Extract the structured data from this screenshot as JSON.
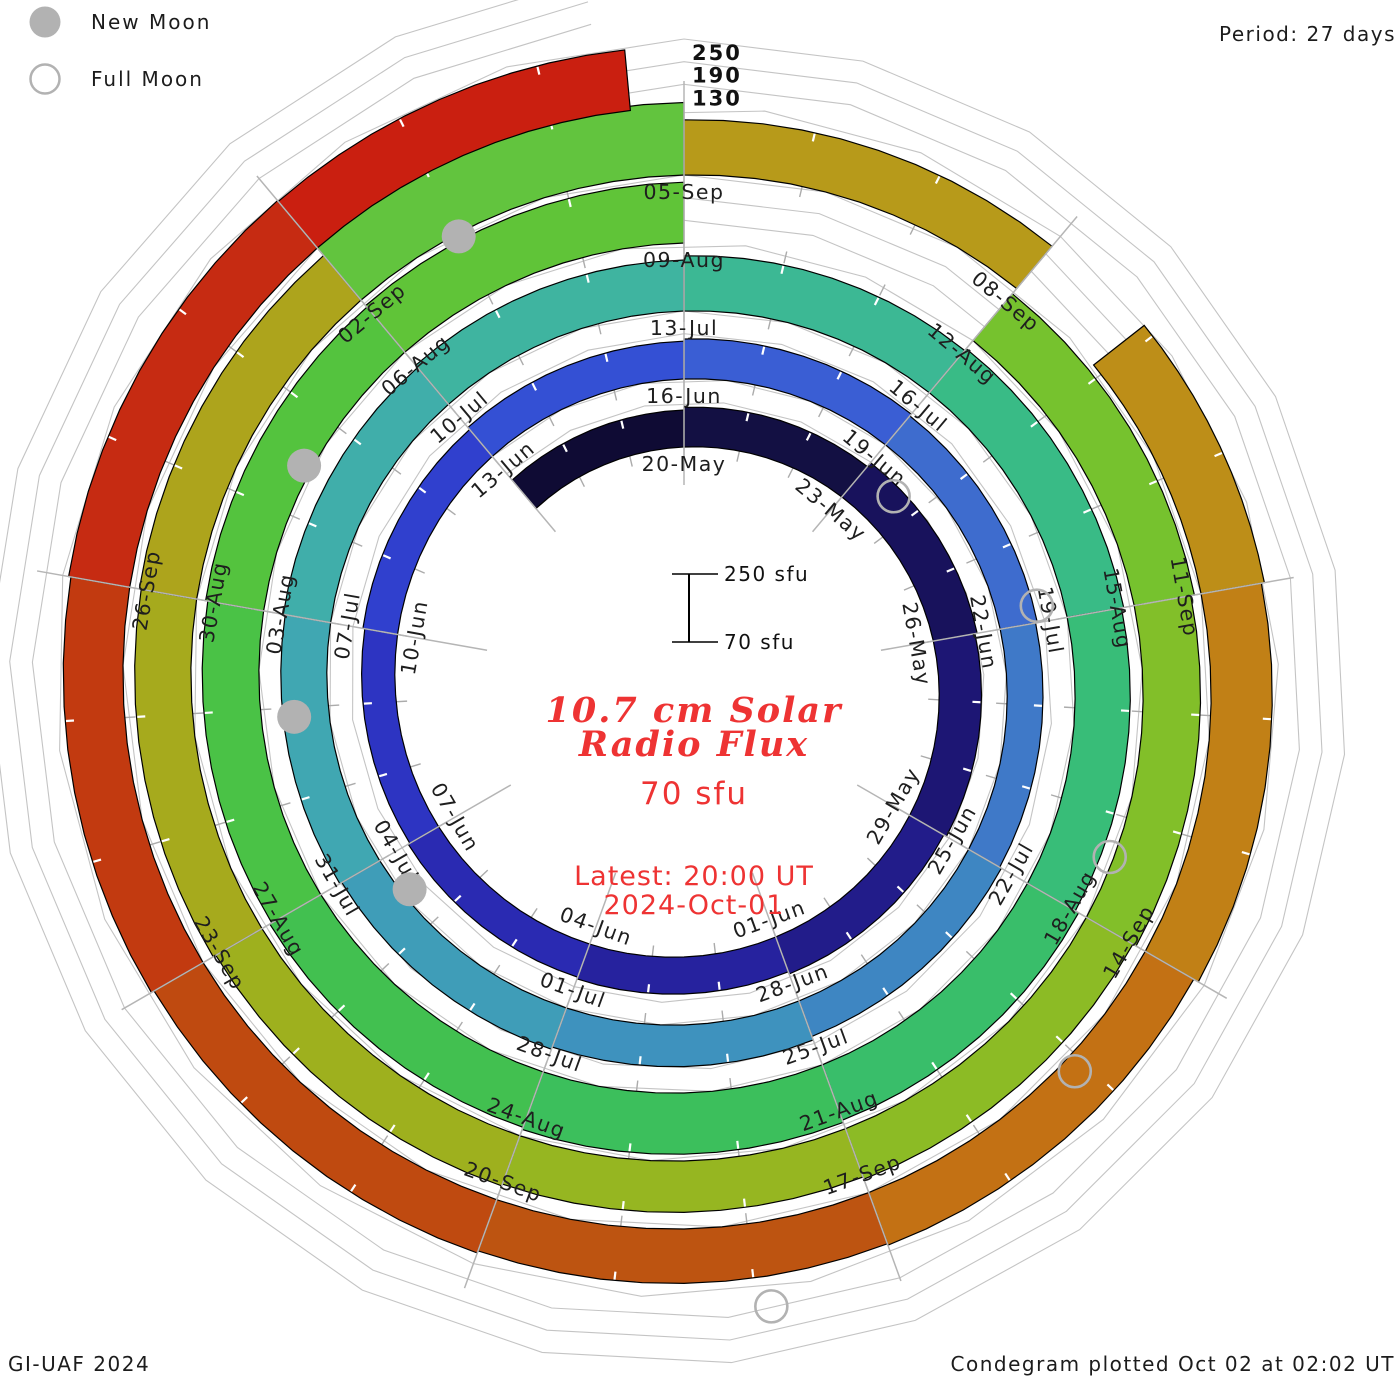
{
  "legend": {
    "items": [
      {
        "label": "New Moon",
        "type": "filled",
        "icon": "new-moon-icon"
      },
      {
        "label": "Full Moon",
        "type": "open",
        "icon": "full-moon-icon"
      }
    ]
  },
  "header": {
    "period_label": "Period: 27 days"
  },
  "footer": {
    "left": "GI-UAF 2024",
    "right": "Condegram plotted Oct 02 at 02:02 UT"
  },
  "center": {
    "title_line1": "10.7 cm Solar",
    "title_line2": "Radio Flux",
    "flux_label": "70 sfu",
    "latest_line1": "Latest: 20:00 UT",
    "latest_line2": "2024-Oct-01",
    "scalebar": {
      "top_label": "250 sfu",
      "bottom_label": "70 sfu"
    }
  },
  "chart_data": {
    "type": "spiral",
    "subtype": "condegram",
    "title": "10.7 cm Solar Radio Flux",
    "period_days": 27,
    "days_per_segment": 3,
    "flux_min": 70,
    "flux_max": 250,
    "radial_ticks": [
      250,
      190,
      130
    ],
    "latest_value_sfu": 70,
    "latest_time": "20:00 UT 2024-Oct-01",
    "grid": true,
    "colors": {
      "grid": "#c4c4c4",
      "spoke": "#b5b5b5",
      "moon": "#b2b2b2",
      "outline": "#000000",
      "label": "#1e1e1e",
      "accent_red": "#ee3333"
    },
    "wedges": [
      {
        "label": "17-May",
        "t0": -3,
        "value": 168,
        "color": "#0f0b34",
        "show_label": false
      },
      {
        "label": "20-May",
        "t0": 0,
        "value": 175,
        "color": "#131043"
      },
      {
        "label": "23-May",
        "t0": 3,
        "value": 188,
        "color": "#18125c"
      },
      {
        "label": "26-May",
        "t0": 6,
        "value": 182,
        "color": "#1d1674"
      },
      {
        "label": "29-May",
        "t0": 9,
        "value": 174,
        "color": "#221c8a"
      },
      {
        "label": "01-Jun",
        "t0": 12,
        "value": 168,
        "color": "#26229e"
      },
      {
        "label": "04-Jun",
        "t0": 15,
        "value": 163,
        "color": "#2a2ab2"
      },
      {
        "label": "07-Jun",
        "t0": 18,
        "value": 158,
        "color": "#2d34c2"
      },
      {
        "label": "10-Jun",
        "t0": 21,
        "value": 163,
        "color": "#3040ce"
      },
      {
        "label": "13-Jun",
        "t0": 24,
        "value": 170,
        "color": "#3450d4"
      },
      {
        "label": "16-Jun",
        "t0": 27,
        "value": 176,
        "color": "#3a5ed4"
      },
      {
        "label": "19-Jun",
        "t0": 30,
        "value": 170,
        "color": "#3e6cce"
      },
      {
        "label": "22-Jun",
        "t0": 33,
        "value": 165,
        "color": "#3f79c8"
      },
      {
        "label": "25-Jun",
        "t0": 36,
        "value": 170,
        "color": "#3e86c2"
      },
      {
        "label": "28-Jun",
        "t0": 39,
        "value": 180,
        "color": "#3e92be"
      },
      {
        "label": "01-Jul",
        "t0": 42,
        "value": 186,
        "color": "#3f9db8"
      },
      {
        "label": "04-Jul",
        "t0": 45,
        "value": 192,
        "color": "#40a7b2"
      },
      {
        "label": "07-Jul",
        "t0": 48,
        "value": 197,
        "color": "#40aeaa"
      },
      {
        "label": "10-Jul",
        "t0": 51,
        "value": 205,
        "color": "#3fb4a0"
      },
      {
        "label": "13-Jul",
        "t0": 54,
        "value": 216,
        "color": "#3cb894"
      },
      {
        "label": "16-Jul",
        "t0": 57,
        "value": 222,
        "color": "#39bb86"
      },
      {
        "label": "19-Jul",
        "t0": 60,
        "value": 216,
        "color": "#38bd78"
      },
      {
        "label": "22-Jul",
        "t0": 63,
        "value": 226,
        "color": "#39be6a"
      },
      {
        "label": "25-Jul",
        "t0": 66,
        "value": 232,
        "color": "#3cbf5c"
      },
      {
        "label": "28-Jul",
        "t0": 69,
        "value": 226,
        "color": "#42c050"
      },
      {
        "label": "31-Jul",
        "t0": 72,
        "value": 220,
        "color": "#4ac246"
      },
      {
        "label": "03-Aug",
        "t0": 75,
        "value": 226,
        "color": "#54c33e"
      },
      {
        "label": "06-Aug",
        "t0": 78,
        "value": 231,
        "color": "#60c438"
      },
      {
        "label": "09-Aug",
        "t0": 81,
        "value": null,
        "color": null
      },
      {
        "label": "12-Aug",
        "t0": 84,
        "value": 232,
        "color": "#76c22e"
      },
      {
        "label": "15-Aug",
        "t0": 87,
        "value": 222,
        "color": "#82bf29"
      },
      {
        "label": "18-Aug",
        "t0": 90,
        "value": 212,
        "color": "#8cbb25"
      },
      {
        "label": "21-Aug",
        "t0": 93,
        "value": 206,
        "color": "#96b621"
      },
      {
        "label": "24-Aug",
        "t0": 96,
        "value": 211,
        "color": "#9eb01e"
      },
      {
        "label": "27-Aug",
        "t0": 99,
        "value": 219,
        "color": "#a6aa1d"
      },
      {
        "label": "30-Aug",
        "t0": 102,
        "value": 224,
        "color": "#ada41c"
      },
      {
        "label": "02-Sep",
        "t0": 105,
        "value": 262,
        "color": "#62c43e"
      },
      {
        "label": "05-Sep",
        "t0": 108,
        "value": 216,
        "color": "#b79a1a"
      },
      {
        "label": "08-Sep",
        "t0": 111,
        "t0_draw": 111.9,
        "value": 240,
        "color": "#bd8e18"
      },
      {
        "label": "11-Sep",
        "t0": 114,
        "value": 232,
        "color": "#c18016"
      },
      {
        "label": "14-Sep",
        "t0": 117,
        "value": 218,
        "color": "#c37114"
      },
      {
        "label": "17-Sep",
        "t0": 120,
        "value": 214,
        "color": "#bd5411"
      },
      {
        "label": "20-Sep",
        "t0": 123,
        "value": 220,
        "color": "#bf4a10"
      },
      {
        "label": "23-Sep",
        "t0": 126,
        "value": 228,
        "color": "#c23a10"
      },
      {
        "label": "26-Sep",
        "t0": 129,
        "value": 234,
        "color": "#c62b12"
      },
      {
        "label": "29-Sep",
        "t0": 132,
        "t1": 134.6,
        "value": 231,
        "color": "#ca1f10",
        "show_label": false
      }
    ],
    "moons": [
      {
        "type": "full",
        "t": 3.6,
        "roff": 35
      },
      {
        "type": "full",
        "t": 32.8,
        "roff": 41
      },
      {
        "type": "full",
        "t": 62.4,
        "roff": 64
      },
      {
        "type": "full",
        "t": 91.1,
        "roff": 82
      },
      {
        "type": "full",
        "t": 120.9,
        "roff": 85
      },
      {
        "type": "new",
        "t": 17.5,
        "roff": 60
      },
      {
        "type": "new",
        "t": 46.9,
        "roff": 35
      },
      {
        "type": "new",
        "t": 76.5,
        "roff": 8
      },
      {
        "type": "new",
        "t": 106.0,
        "roff": -3
      }
    ]
  }
}
